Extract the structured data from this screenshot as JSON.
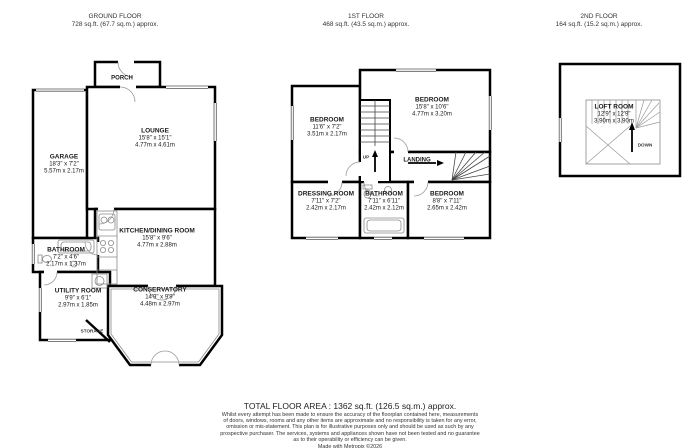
{
  "floors": {
    "ground": {
      "title": "GROUND FLOOR",
      "area": "728 sq.ft. (67.7 sq.m.) approx."
    },
    "first": {
      "title": "1ST FLOOR",
      "area": "468 sq.ft. (43.5 sq.m.) approx."
    },
    "second": {
      "title": "2ND FLOOR",
      "area": "164 sq.ft. (15.2 sq.m.) approx."
    }
  },
  "rooms": {
    "lounge": {
      "name": "LOUNGE",
      "imperial": "15'8\" x 15'1\"",
      "metric": "4.77m x 4.61m"
    },
    "garage": {
      "name": "GARAGE",
      "imperial": "18'3\" x 7'2\"",
      "metric": "5.57m x 2.17m"
    },
    "kitchen": {
      "name": "KITCHEN/DINING ROOM",
      "imperial": "15'8\" x 9'6\"",
      "metric": "4.77m x 2.88m"
    },
    "bathroom_gf": {
      "name": "BATHROOM",
      "imperial": "7'2\" x 4'6\"",
      "metric": "2.17m x 1.37m"
    },
    "utility": {
      "name": "UTILITY ROOM",
      "imperial": "9'9\" x 6'1\"",
      "metric": "2.97m x 1.85m"
    },
    "conservatory": {
      "name": "CONSERVATORY",
      "imperial": "14'9\" x 9'9\"",
      "metric": "4.48m x 2.97m"
    },
    "porch": {
      "name": "PORCH"
    },
    "storage": {
      "name": "STORAGE"
    },
    "bedroom1": {
      "name": "BEDROOM",
      "imperial": "11'6\" x 7'2\"",
      "metric": "3.51m x 2.17m"
    },
    "bedroom2": {
      "name": "BEDROOM",
      "imperial": "15'8\" x 10'6\"",
      "metric": "4.77m x 3.20m"
    },
    "dressing": {
      "name": "DRESSING ROOM",
      "imperial": "7'11\" x 7'2\"",
      "metric": "2.42m x 2.17m"
    },
    "bathroom_ff": {
      "name": "BATHROOM",
      "imperial": "7'11\" x 6'11\"",
      "metric": "2.42m x 2.12m"
    },
    "bedroom3": {
      "name": "BEDROOM",
      "imperial": "8'8\" x 7'11\"",
      "metric": "2.65m x 2.42m"
    },
    "landing": {
      "name": "LANDING"
    },
    "loft": {
      "name": "LOFT ROOM",
      "imperial": "12'9\" x 12'9\"",
      "metric": "3.90m x 3.90m"
    }
  },
  "stairs": {
    "up": "UP",
    "down": "DOWN"
  },
  "footer": {
    "total": "TOTAL FLOOR AREA : 1362 sq.ft. (126.5 sq.m.) approx.",
    "disclaimer": "Whilst every attempt has been made to ensure the accuracy of the floorplan contained here, measurements of doors, windows, rooms and any other items are approximate and no responsibility is taken for any error, omission or mis-statement. This plan is for illustrative purposes only and should be used as such by any prospective purchaser. The services, systems and appliances shown have not been tested and no guarantee as to their operability or efficiency can be given.",
    "credit": "Made with Metropix ©2026"
  },
  "colors": {
    "wall": "#000000",
    "background": "#ffffff",
    "detail": "#8a8a8a",
    "text": "#1a1a1a"
  }
}
